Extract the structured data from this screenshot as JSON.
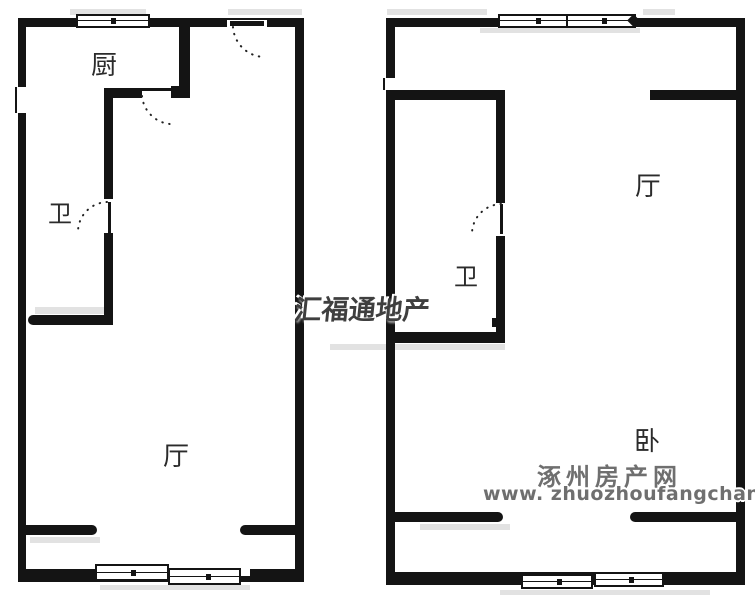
{
  "canvas": {
    "background": "#ffffff",
    "wall_color": "#141414",
    "shadow_color": "#e2e2e2",
    "label_color": "#2b2b2b"
  },
  "left_unit": {
    "kitchen_label": "厨",
    "bath_label": "卫",
    "living_label": "厅"
  },
  "right_unit": {
    "living_label": "厅",
    "bath_label": "卫",
    "bed_label": "卧"
  },
  "watermarks": {
    "agency": "汇福通地产",
    "agency_color": "#3f3f3f",
    "site_name": "涿州房产网",
    "site_url": "www. zhuozhoufangchan. com",
    "site_color": "#6f6f6f"
  }
}
